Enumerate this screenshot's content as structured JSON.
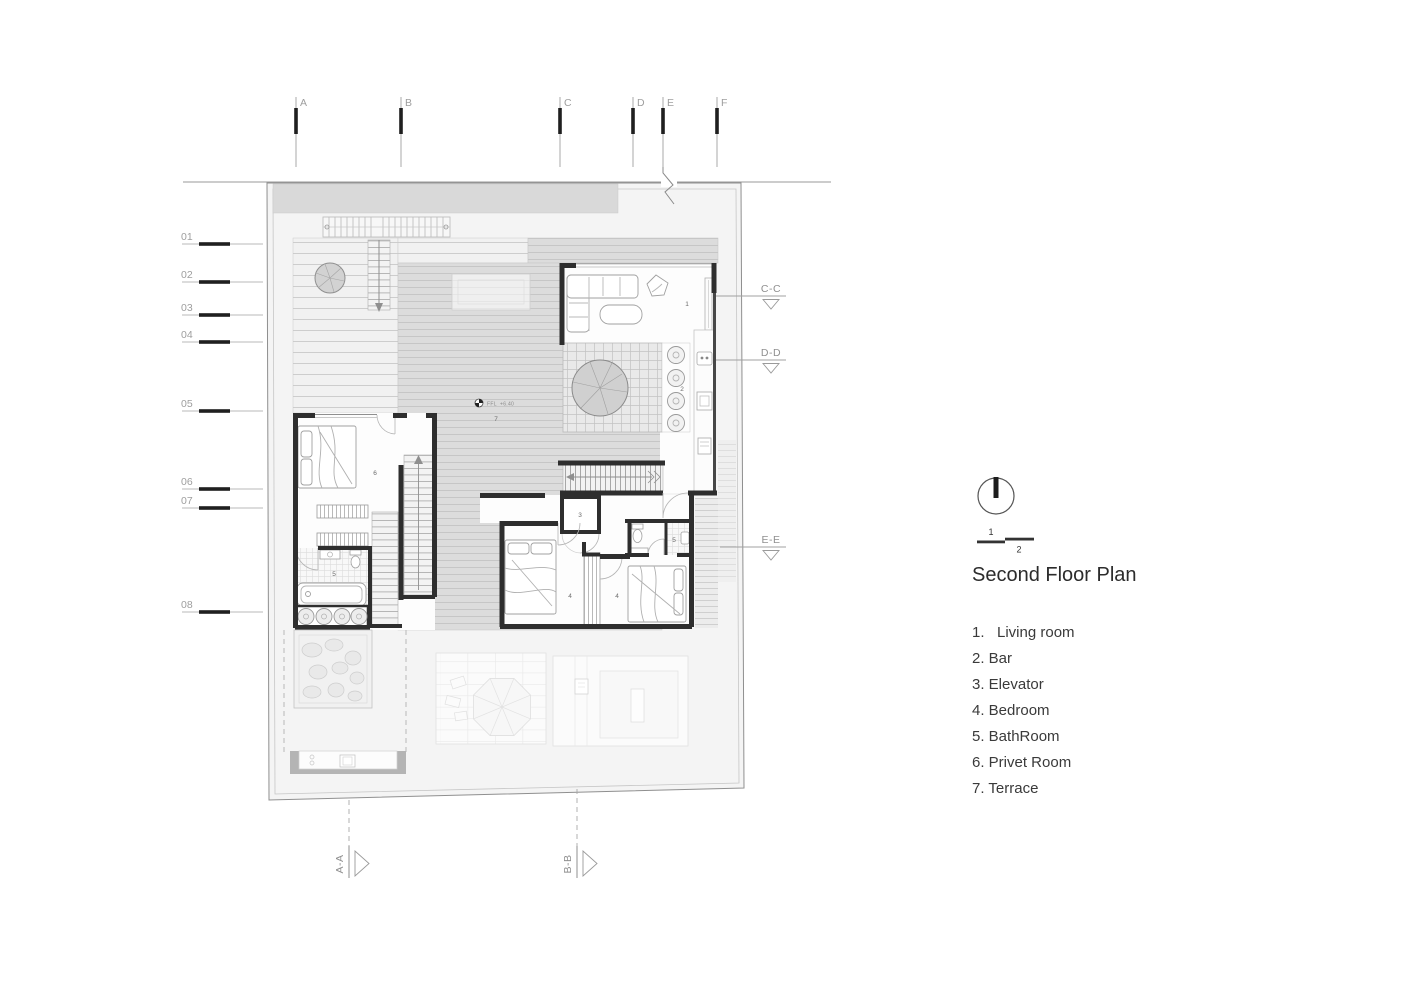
{
  "drawing": {
    "title": "Second Floor Plan",
    "level_marker": "FFL  +6.40",
    "scale_bar": {
      "upper_label": "1",
      "lower_label": "2"
    }
  },
  "grid": {
    "columns": [
      {
        "label": "A"
      },
      {
        "label": "B"
      },
      {
        "label": "C"
      },
      {
        "label": "D"
      },
      {
        "label": "E"
      },
      {
        "label": "F"
      }
    ],
    "rows": [
      {
        "label": "01"
      },
      {
        "label": "02"
      },
      {
        "label": "03"
      },
      {
        "label": "04"
      },
      {
        "label": "05"
      },
      {
        "label": "06"
      },
      {
        "label": "07"
      },
      {
        "label": "08"
      }
    ]
  },
  "section_markers": {
    "right": [
      {
        "label": "C-C"
      },
      {
        "label": "D-D"
      },
      {
        "label": "E-E"
      }
    ],
    "bottom": [
      {
        "label": "A-A"
      },
      {
        "label": "B-B"
      }
    ]
  },
  "rooms": {
    "living_room": "1",
    "bar": "2",
    "elevator": "3",
    "bedroom": "4",
    "bathroom": "5",
    "privet_room": "6",
    "terrace": "7"
  },
  "legend": {
    "items": [
      {
        "text": "1.   Living room"
      },
      {
        "text": "2. Bar"
      },
      {
        "text": "3. Elevator"
      },
      {
        "text": "4. Bedroom"
      },
      {
        "text": "5. BathRoom"
      },
      {
        "text": "6. Privet Room"
      },
      {
        "text": "7. Terrace"
      }
    ]
  },
  "colors": {
    "wall": "#2e2e2e",
    "marker_dark": "#1f1f1f",
    "line_gray": "#9e9e9e",
    "site_fill": "#f4f4f4",
    "roof_band": "#d9d9d9",
    "deck_medium": "#dcdcdc",
    "text_dark": "#2c2c2c",
    "text_gray": "#8f8f8f"
  }
}
